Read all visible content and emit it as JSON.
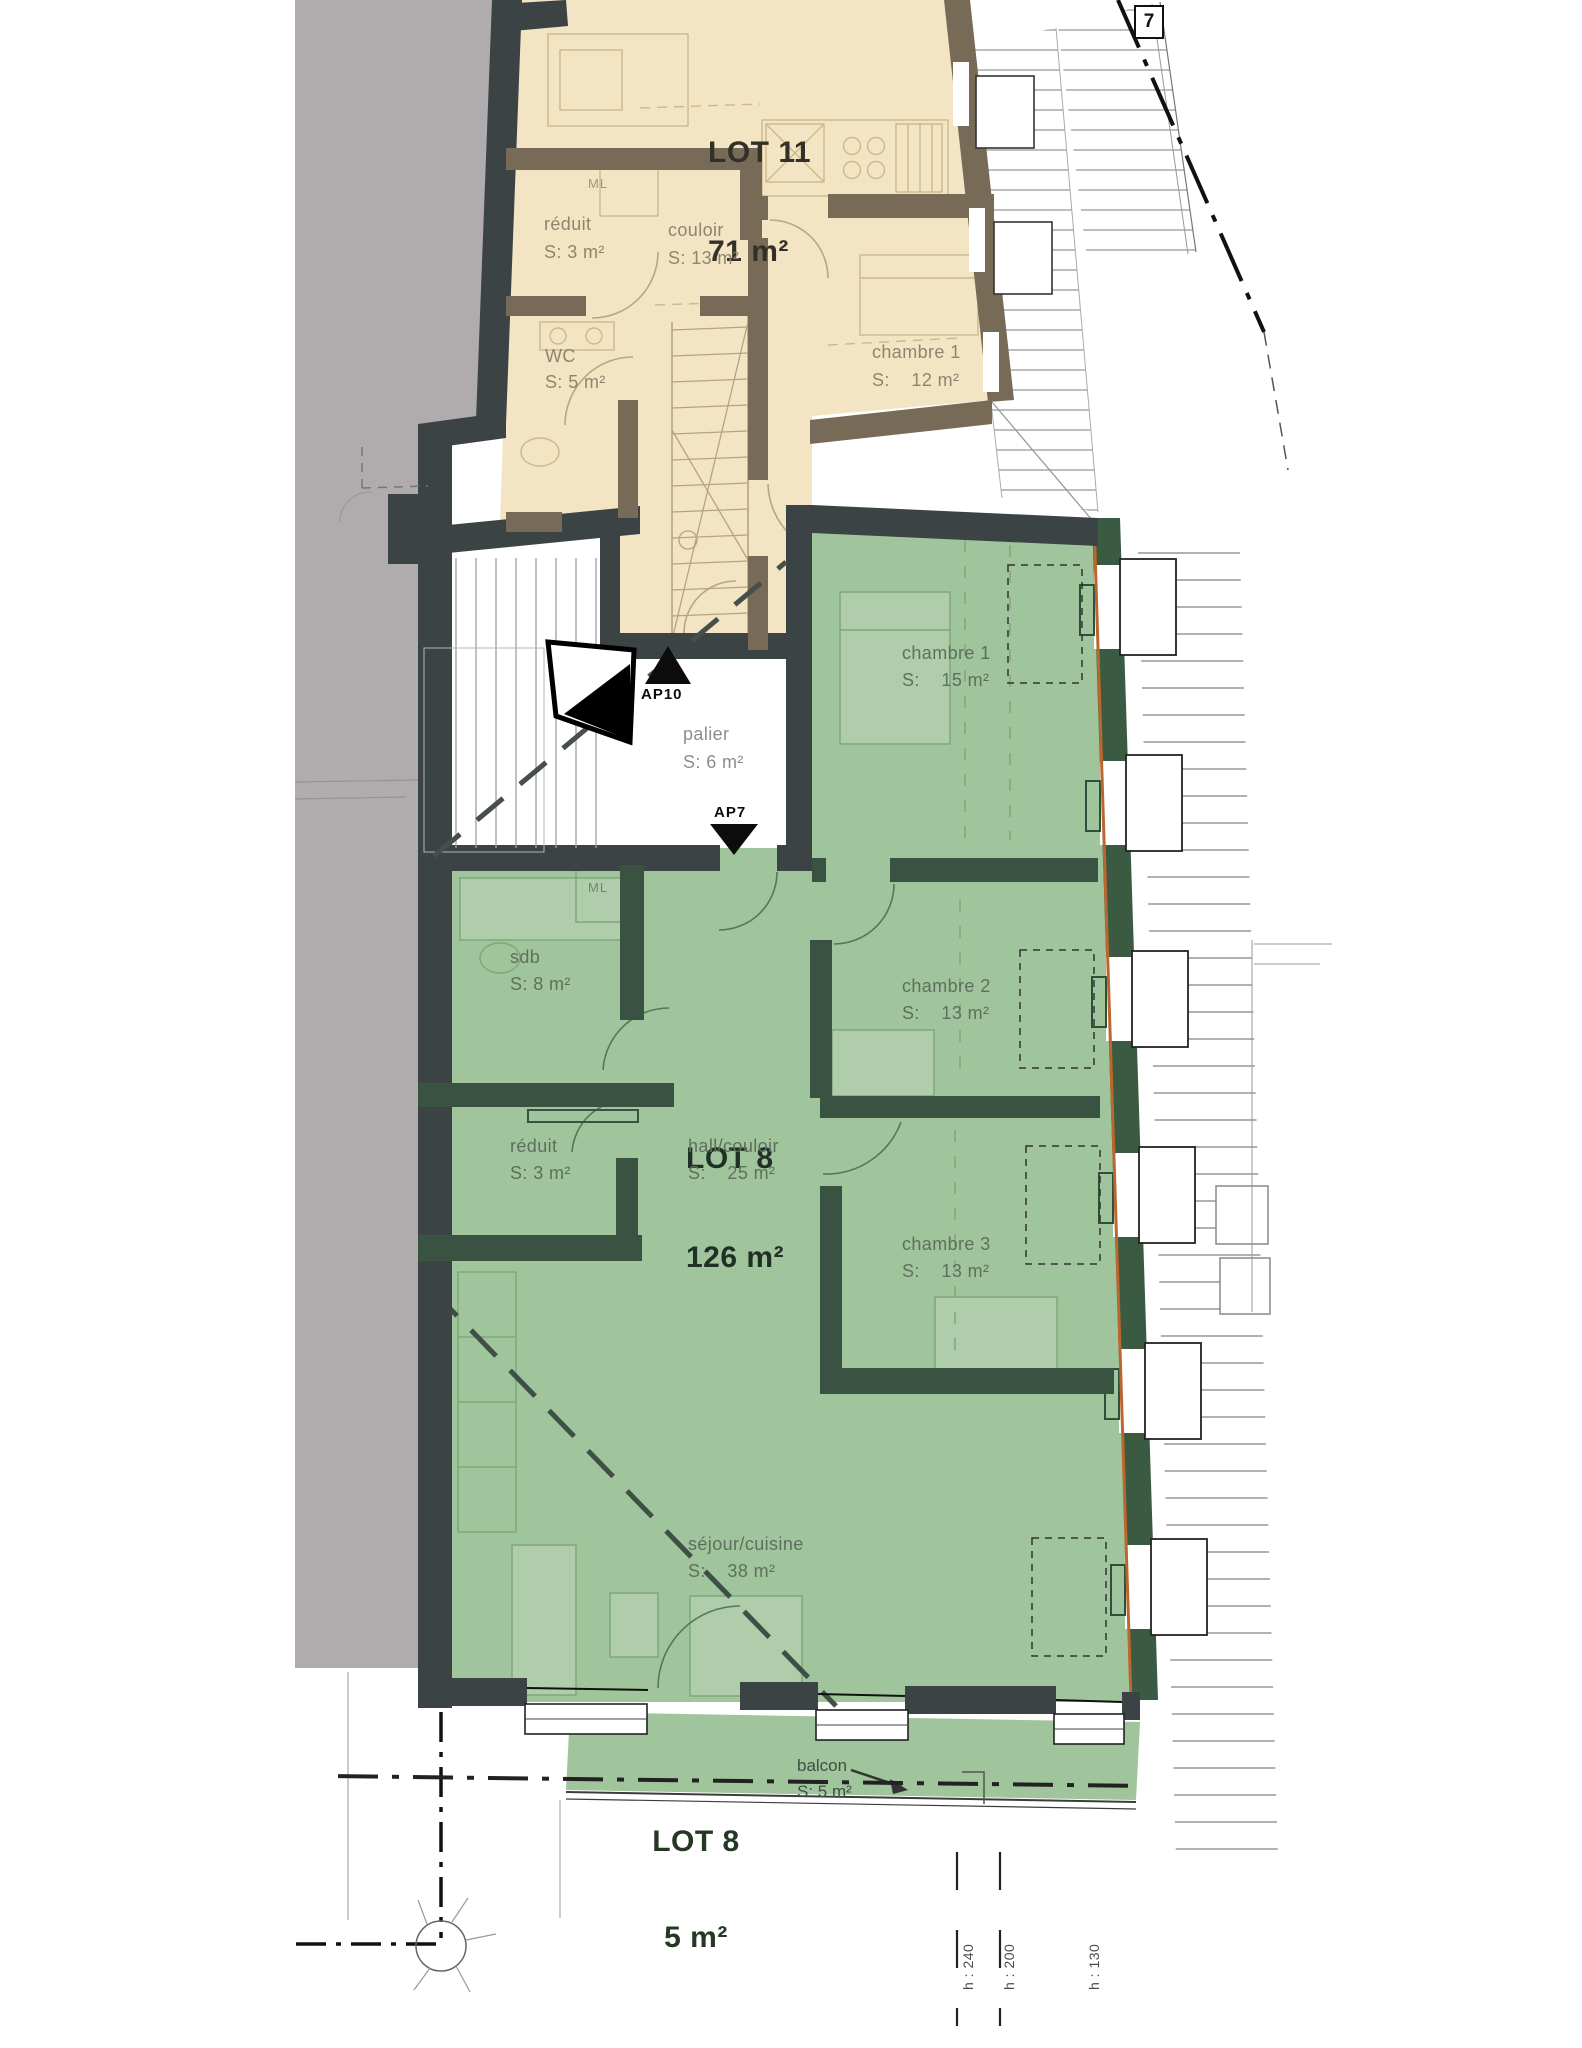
{
  "sheet": {
    "marker_box": "7"
  },
  "lot11": {
    "title": "LOT 11",
    "area": "71 m²",
    "rooms": {
      "reduit": {
        "name": "réduit",
        "area": "S: 3 m²"
      },
      "couloir": {
        "name": "couloir",
        "area": "S: 13 m²"
      },
      "wc": {
        "name": "WC",
        "area": "S: 5 m²"
      },
      "chambre1": {
        "name": "chambre 1",
        "area": "S:    12 m²"
      },
      "ml": "ML"
    }
  },
  "stairwell": {
    "ap10": "AP10",
    "ap7": "AP7",
    "palier": {
      "name": "palier",
      "area": "S: 6 m²"
    }
  },
  "lot8": {
    "title": "LOT 8",
    "area": "126 m²",
    "rooms": {
      "chambre1": {
        "name": "chambre 1",
        "area": "S:    15 m²"
      },
      "sdb": {
        "name": "sdb",
        "area": "S: 8 m²"
      },
      "chambre2": {
        "name": "chambre 2",
        "area": "S:    13 m²"
      },
      "hall": {
        "name": "hall/couloir",
        "area": "S:    25 m²"
      },
      "reduit": {
        "name": "réduit",
        "area": "S: 3 m²"
      },
      "chambre3": {
        "name": "chambre 3",
        "area": "S:    13 m²"
      },
      "sejour": {
        "name": "séjour/cuisine",
        "area": "S:    38 m²"
      },
      "ml": "ML"
    },
    "balcony": {
      "name": "balcon",
      "area": "S: 5 m²",
      "title": "LOT 8",
      "title_area": "5 m²"
    }
  },
  "annotations": {
    "h1": "h : 240",
    "h2": "h : 200",
    "h3": "h : 130"
  },
  "colors": {
    "lot11_fill": "#f3e5c3",
    "lot8_fill": "#a0c49b",
    "wall_dark": "#3b4345",
    "wall_brown": "#776b58",
    "wall_green": "#3a5a42",
    "facade_accent": "#b9672e",
    "neighbor_grey": "#b0abac"
  }
}
